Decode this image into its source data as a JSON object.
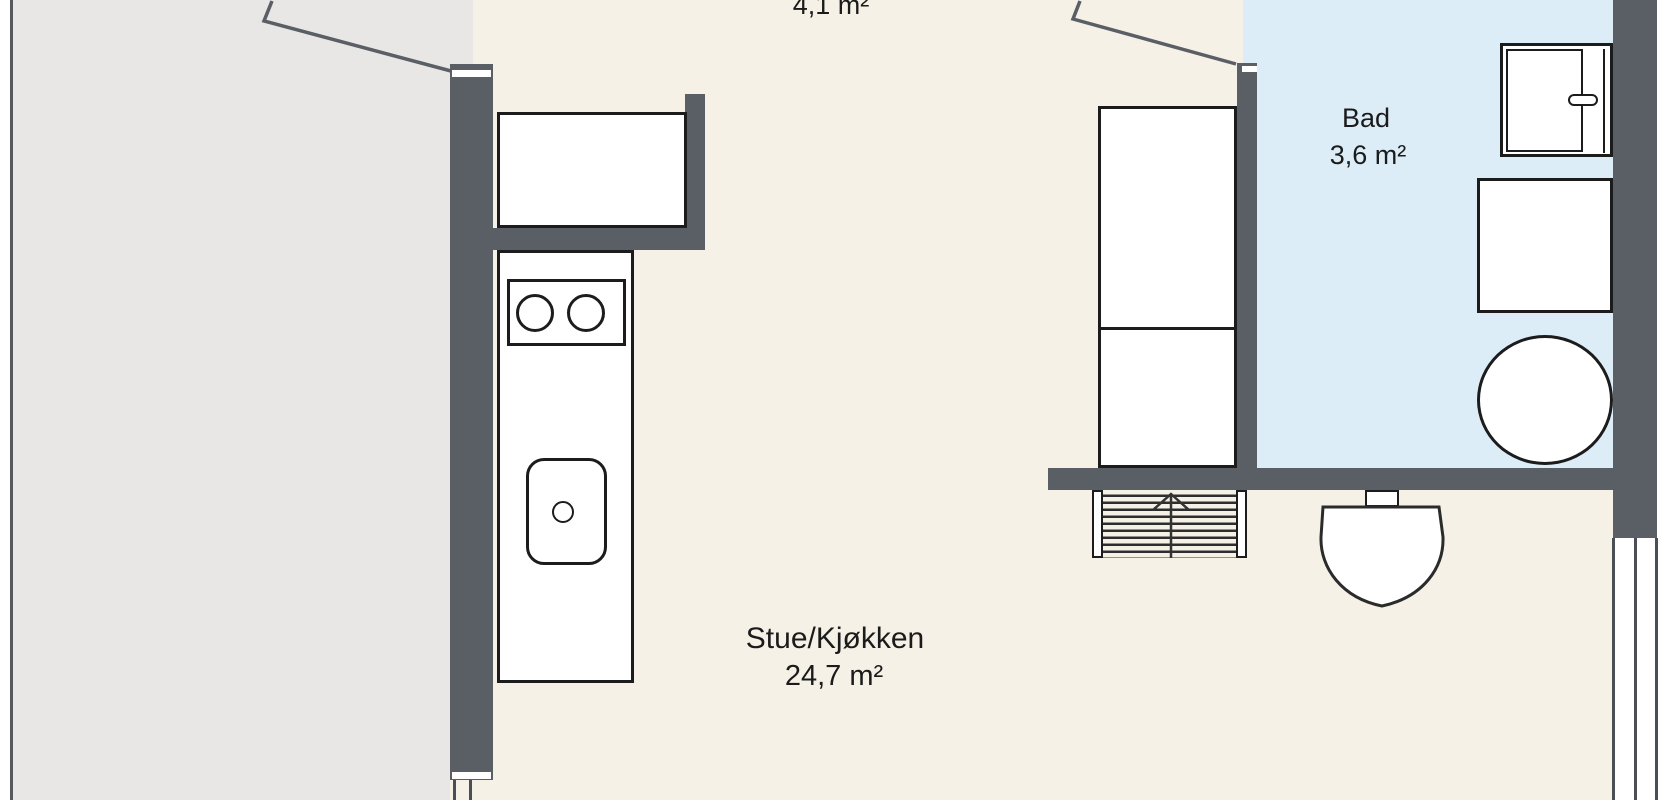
{
  "floorplan": {
    "rooms": {
      "hall": {
        "area": "4,1 m²"
      },
      "bathroom": {
        "name": "Bad",
        "area": "3,6 m²"
      },
      "living_kitchen": {
        "name": "Stue/Kjøkken",
        "area": "24,7 m²"
      }
    },
    "colors": {
      "floor": "#f6f1e6",
      "bathroom": "#dcedf8",
      "wall": "#5a5e65",
      "outside": "#e8e7e6",
      "line": "#1c1c1c"
    }
  }
}
